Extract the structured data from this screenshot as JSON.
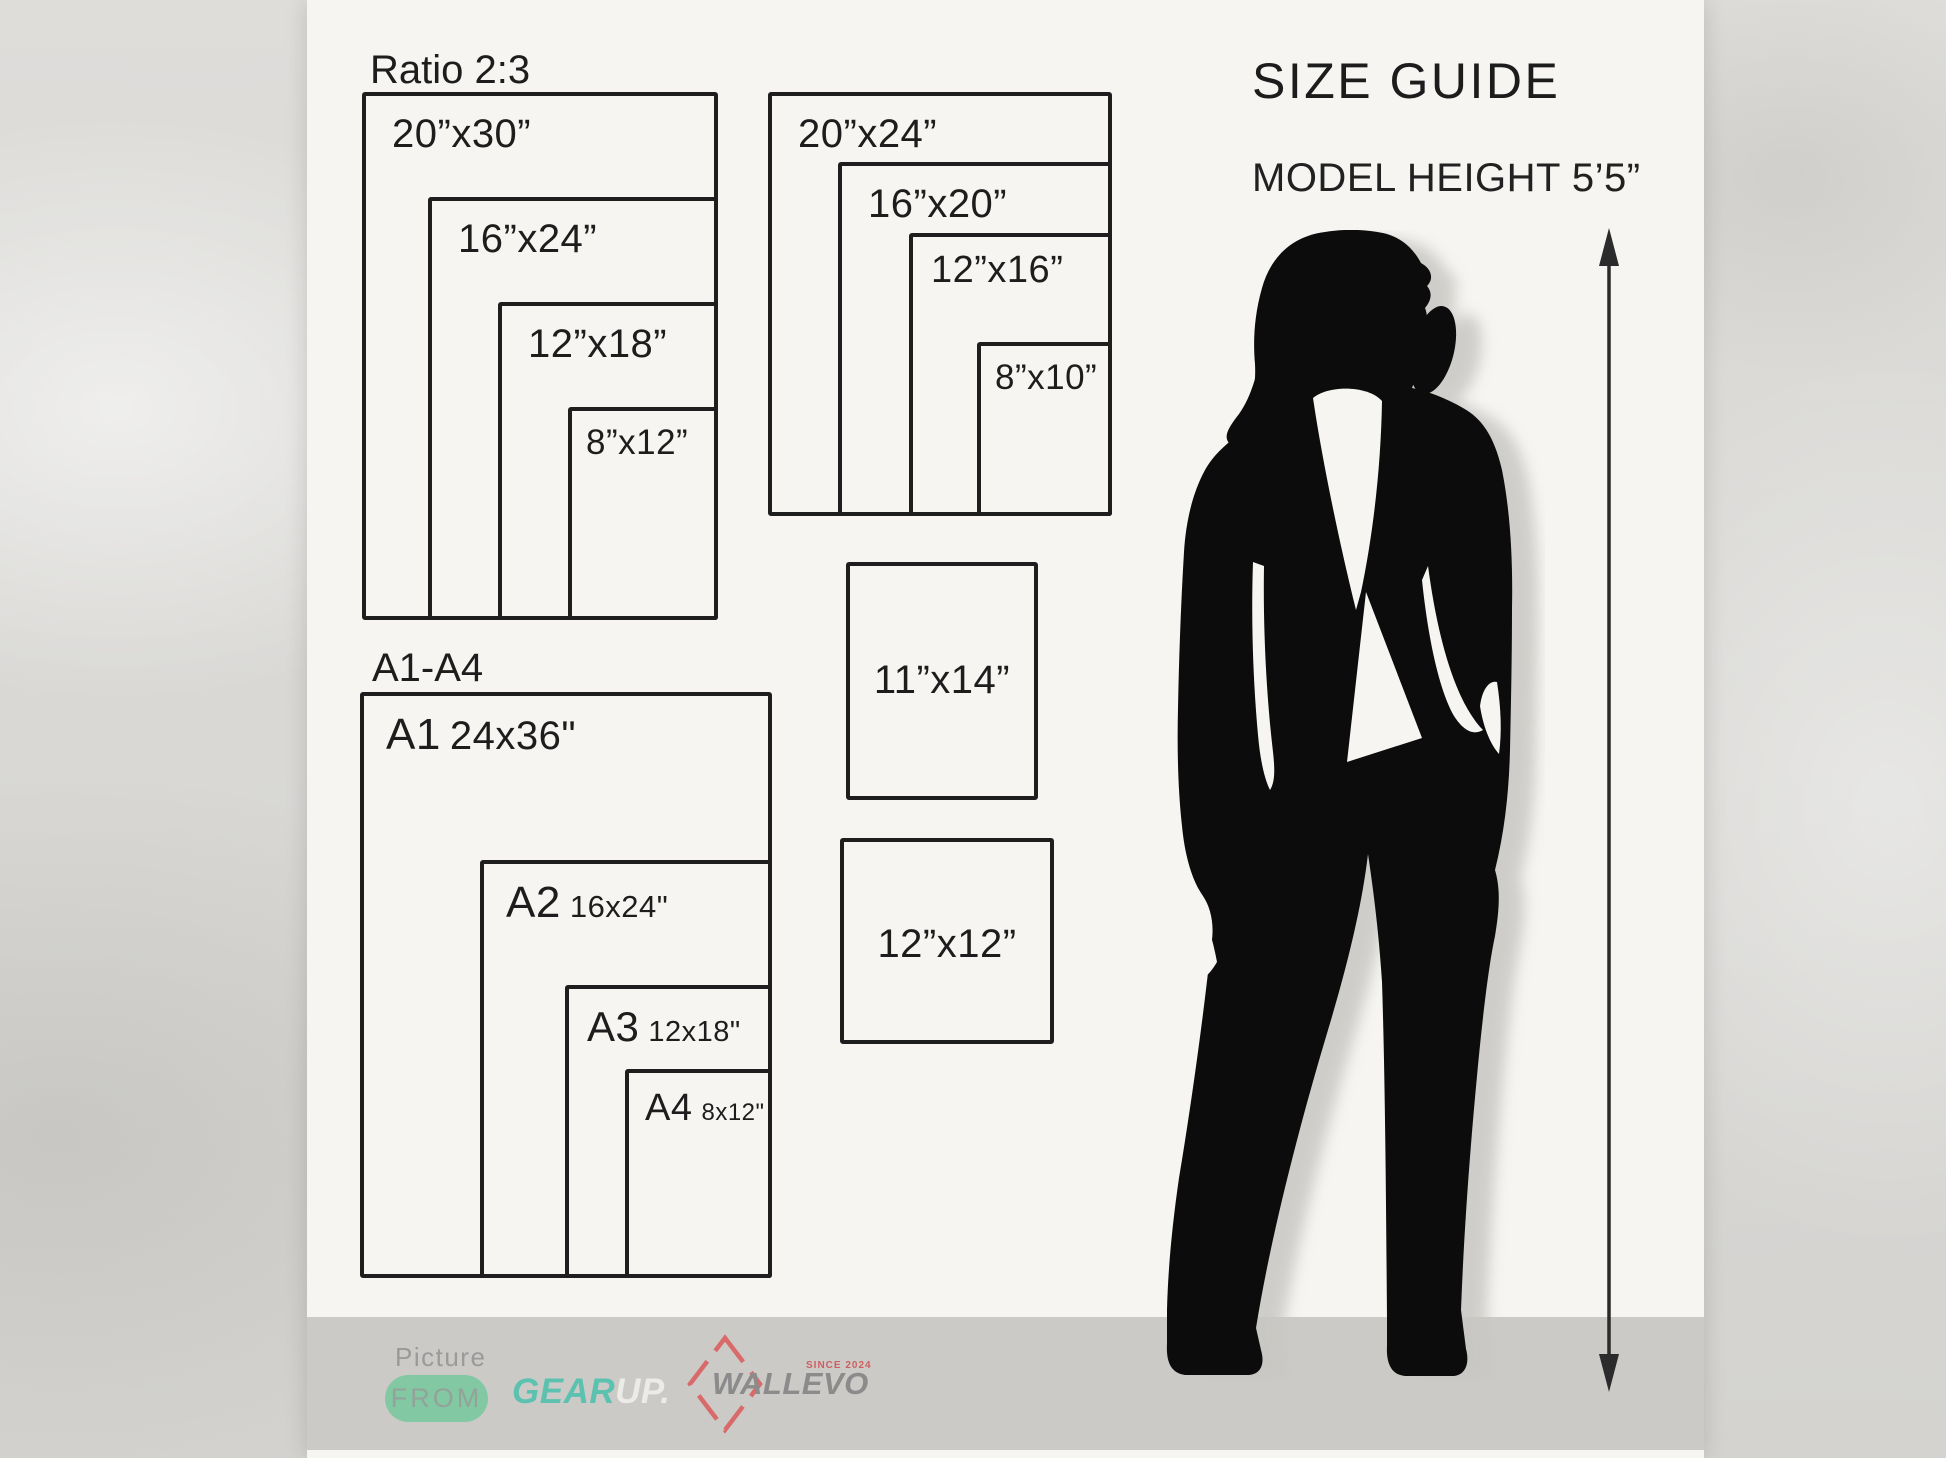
{
  "header": {
    "title": "SIZE GUIDE",
    "model_height": "MODEL HEIGHT 5’5”"
  },
  "ratio_group": {
    "label": "Ratio 2:3",
    "boxes": [
      {
        "size": "20”x30”"
      },
      {
        "size": "16”x24”"
      },
      {
        "size": "12”x18”"
      },
      {
        "size": "8”x12”"
      }
    ]
  },
  "standard_group": {
    "boxes": [
      {
        "size": "20”x24”"
      },
      {
        "size": "16”x20”"
      },
      {
        "size": "12”x16”"
      },
      {
        "size": "8”x10”"
      }
    ]
  },
  "single_boxes": [
    {
      "size": "11”x14”"
    },
    {
      "size": "12”x12”"
    }
  ],
  "a_group": {
    "label": "A1-A4",
    "boxes": [
      {
        "name": "A1",
        "size": "24x36\""
      },
      {
        "name": "A2",
        "size": "16x24\""
      },
      {
        "name": "A3",
        "size": "12x18\""
      },
      {
        "name": "A4",
        "size": "8x12\""
      }
    ]
  },
  "footer": {
    "picture": "Picture",
    "from": "FROM",
    "gear": "GEAR",
    "up": "UP.",
    "brand": "WALLEVO",
    "since": "SINCE 2024"
  },
  "colors": {
    "panel": "#f6f5f2",
    "floor": "#cbcac7",
    "line": "#1e1e1e",
    "silhouette": "#0c0c0c",
    "shadow": "#c9c7c3",
    "pill_green": "#82c8a2",
    "pill_text": "#93a29a",
    "gear_teal": "#5cc2af",
    "up_white": "#ebebe8",
    "brand_gray": "#8b8b8b",
    "logo_red": "#d96a6a"
  }
}
